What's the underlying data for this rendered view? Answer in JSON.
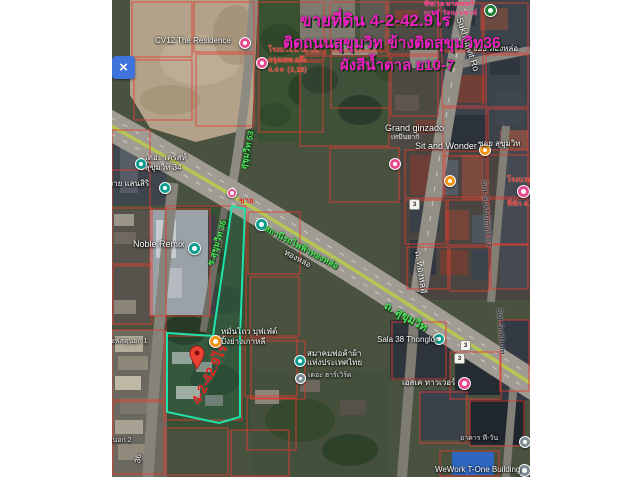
{
  "ad": {
    "line1": "ขายที่ดิน 4-2-42.9ไร่",
    "line2": "ติดถนนสุขุมวิท ข้างติดสุขุมวิท36",
    "line3": "ผังสีน้ำตาล ย10-7",
    "color": "#ee1fc2"
  },
  "property": {
    "area_label": "4-2-42.9ไร่",
    "sale_tag": "ขาย",
    "outline_color": "#1fe3ac",
    "pin_color": "#ea4335"
  },
  "roads": {
    "bts_station": "สถานีรถไฟฟ้าทองหล่อ",
    "bts_station_short": "ทองหล่อ",
    "sukhumvit_th": "ถ. สุขุมวิท",
    "sukhumvit_en": "Sukhumvit Ro",
    "thonglor": "ถ. ทองหล่อ",
    "soi53": "สุขุมวิท 53",
    "soi36": "ซ.สุขุมวิท 36",
    "soi36_part": "36",
    "soi57": "Soi Sukhumvit 57",
    "soi57_part": "Soi Sukhum",
    "soi_thonglor": "ซอย ทองหล่อ",
    "soi_sukhumvit": "ซอย สุขุมวิท",
    "route3": "3"
  },
  "places": {
    "cv12": {
      "label": "CV12 The Residence"
    },
    "hotel_nadee": {
      "line1": "โรงแรมนาดี ไป",
      "line2": "กรุงเทพ อดีเ",
      "line3": "4.4★ (3,18)"
    },
    "peachwell": {
      "line1": "พีชเวล มาสเตอร์",
      "line2": "เมนต์ วัฒนาเซาท์"
    },
    "crest": {
      "line1": "เดอะ เครสท์",
      "line2": "สุขุมวิท 34"
    },
    "sansiri": {
      "label": "บาย แสนสิริ"
    },
    "noble": {
      "label": "Noble Remix"
    },
    "grand_ginzado": {
      "label": "Grand ginzado",
      "sub": "เทปันยากิ"
    },
    "sit_and_wonder": {
      "label": "Sit and Wonder"
    },
    "hotel_right": {
      "line1": "โรงแรม",
      "line2": "ที่พัก 4.7★"
    },
    "manthou": {
      "line1": "หมั่นโถว บุฟเฟ่ต์",
      "line2": "ปิ้งย่างเกาหลี"
    },
    "samakhom": {
      "line1": "สมาคมพ่อค้าผ้า",
      "line2": "แห่งประเทศไทย"
    },
    "harvard": {
      "label": "เดอะ ฮาร์เวิร์ด"
    },
    "sala38": {
      "label": "Sala 38 Thonglor"
    },
    "sk_tower": {
      "label": "เอสเค ทาวเวอร์"
    },
    "t_one": {
      "label": "อาคาร ที-วัน"
    },
    "wework": {
      "label": "WeWork T-One Building"
    },
    "rachaphatsadu1": {
      "label": "ที่ราชพัสดุนอก 1"
    },
    "rachaphatsadu2": {
      "label": "ที่ราชพัสดุนอก 2"
    }
  }
}
